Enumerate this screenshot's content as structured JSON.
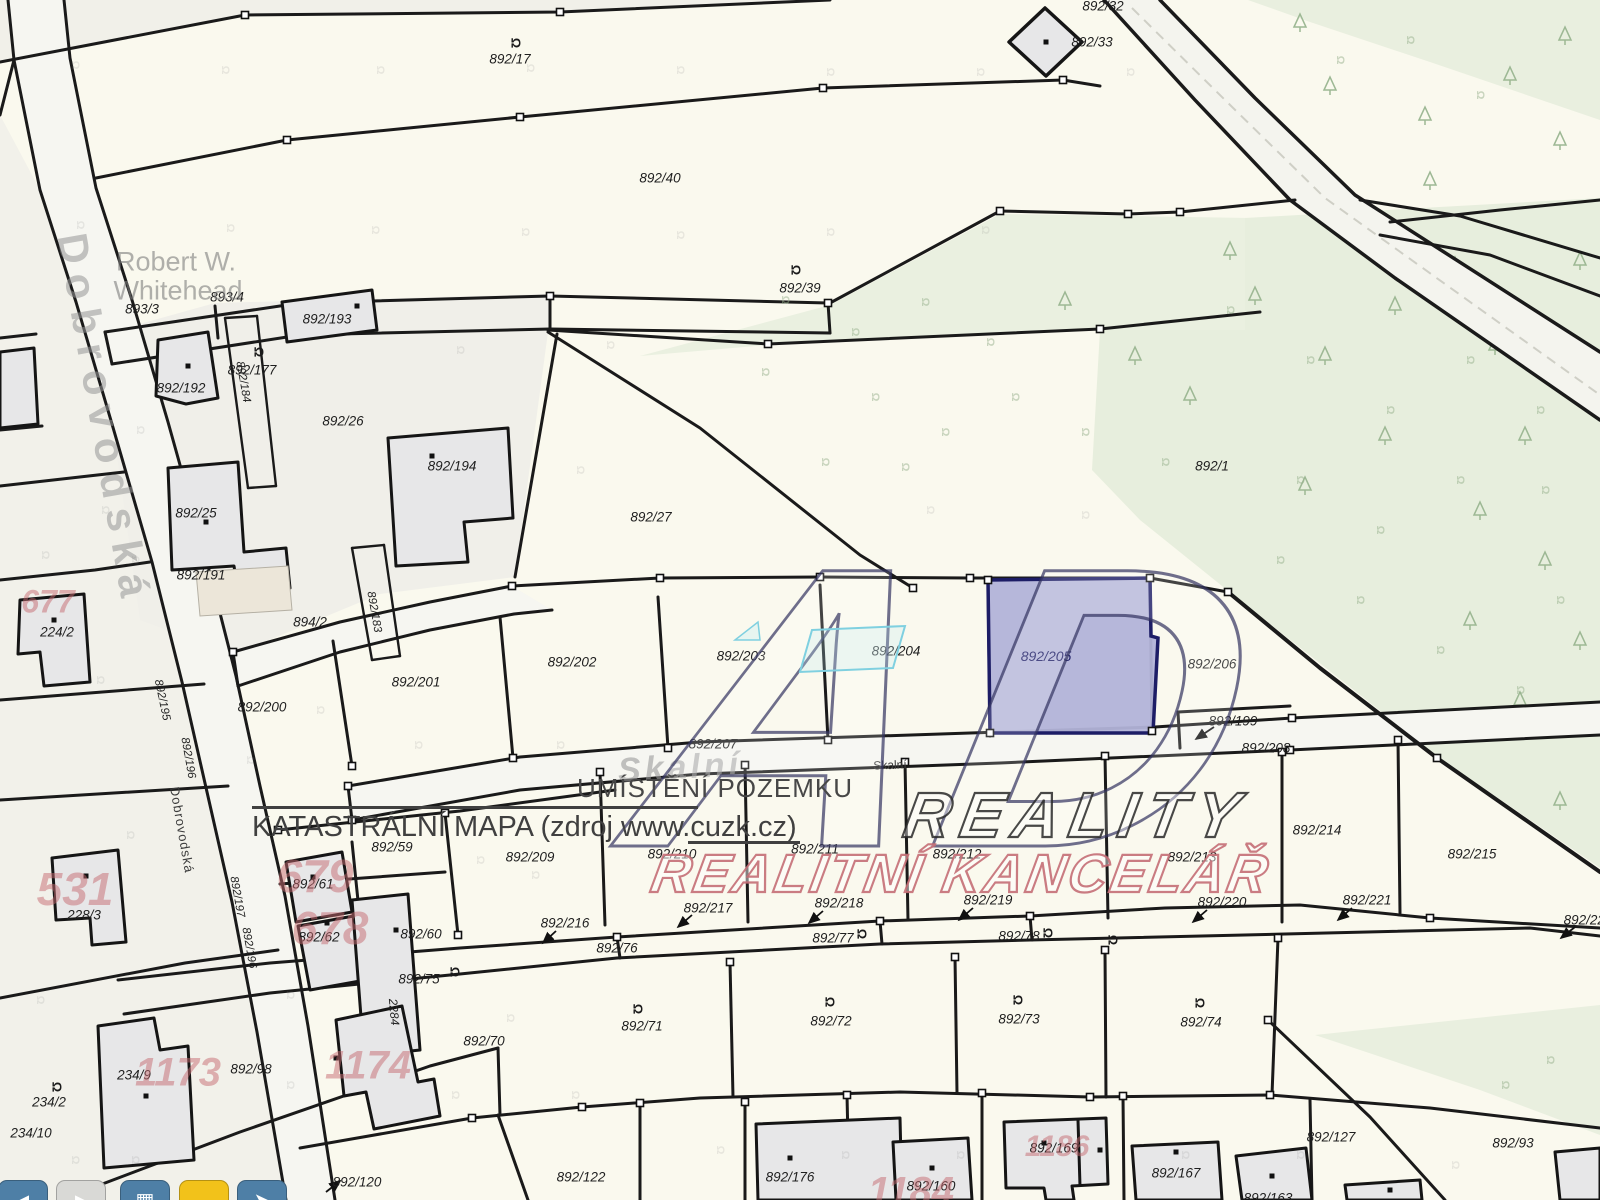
{
  "map": {
    "notes": {
      "placement": "UMÍSTĚNÍ POZEMKU",
      "source": "KATASTRÁLNÍ MAPA (zdroj www.cuzk.cz)"
    },
    "watermark": {
      "logo": "AD",
      "line1": "REALITY",
      "line2": "REALITNÍ KANCELÁŘ"
    },
    "highlighted_parcel": "892/205",
    "colors": {
      "highlight_fill": "#b2b3d8",
      "highlight_border": "#1d1d66",
      "map_background": "#faf9ee",
      "forest_green": "#e9efdf",
      "building_grey": "#e7e7e8",
      "red_number": "#c66970",
      "toolbar_blue": "#4e7fa6",
      "toolbar_yellow": "#f2c21a",
      "toolbar_grey": "#d9d9d6"
    },
    "labels": [
      [
        "892/17",
        510,
        59,
        "p"
      ],
      [
        "892/32",
        1103,
        6,
        "p"
      ],
      [
        "892/33",
        1092,
        42,
        "p"
      ],
      [
        "892/40",
        660,
        178,
        "p"
      ],
      [
        "892/39",
        800,
        288,
        "p"
      ],
      [
        "892/1",
        1212,
        466,
        "p"
      ],
      [
        "893/3",
        142,
        309,
        "p"
      ],
      [
        "893/4",
        227,
        297,
        "p"
      ],
      [
        "892/193",
        327,
        319,
        "p"
      ],
      [
        "892/177",
        252,
        370,
        "p"
      ],
      [
        "892/192",
        181,
        388,
        "p"
      ],
      [
        "892/26",
        343,
        421,
        "p"
      ],
      [
        "892/194",
        452,
        466,
        "p"
      ],
      [
        "892/25",
        196,
        513,
        "p"
      ],
      [
        "892/191",
        201,
        575,
        "p"
      ],
      [
        "892/27",
        651,
        517,
        "p"
      ],
      [
        "894/2",
        310,
        622,
        "p"
      ],
      [
        "224/2",
        57,
        632,
        "p"
      ],
      [
        "892/200",
        262,
        707,
        "p"
      ],
      [
        "892/201",
        416,
        682,
        "p"
      ],
      [
        "892/202",
        572,
        662,
        "p"
      ],
      [
        "892/203",
        741,
        656,
        "p"
      ],
      [
        "892/204",
        896,
        651,
        "p"
      ],
      [
        "892/205",
        1046,
        656,
        "pn",
        14
      ],
      [
        "892/206",
        1212,
        664,
        "p"
      ],
      [
        "892/199",
        1233,
        721,
        "p"
      ],
      [
        "892/207",
        713,
        744,
        "p"
      ],
      [
        "892/208",
        1266,
        748,
        "p"
      ],
      [
        "892/214",
        1317,
        830,
        "p"
      ],
      [
        "892/215",
        1472,
        854,
        "p"
      ],
      [
        "892/213",
        1192,
        857,
        "p"
      ],
      [
        "892/212",
        957,
        854,
        "p"
      ],
      [
        "892/211",
        815,
        849,
        "p"
      ],
      [
        "892/210",
        672,
        854,
        "p"
      ],
      [
        "892/209",
        530,
        857,
        "p"
      ],
      [
        "892/59",
        392,
        847,
        "p"
      ],
      [
        "892/61",
        313,
        884,
        "p"
      ],
      [
        "892/62",
        319,
        937,
        "p"
      ],
      [
        "892/60",
        421,
        934,
        "p"
      ],
      [
        "892/216",
        565,
        923,
        "p"
      ],
      [
        "892/217",
        708,
        908,
        "p"
      ],
      [
        "892/218",
        839,
        903,
        "p"
      ],
      [
        "892/219",
        988,
        900,
        "p"
      ],
      [
        "892/220",
        1222,
        902,
        "p"
      ],
      [
        "892/221",
        1367,
        900,
        "p"
      ],
      [
        "892/222",
        1588,
        920,
        "p"
      ],
      [
        "892/75",
        419,
        979,
        "p"
      ],
      [
        "892/76",
        617,
        948,
        "p"
      ],
      [
        "892/77",
        833,
        938,
        "p"
      ],
      [
        "892/78",
        1019,
        936,
        "p"
      ],
      [
        "892/71",
        642,
        1026,
        "p"
      ],
      [
        "892/72",
        831,
        1021,
        "p"
      ],
      [
        "892/73",
        1019,
        1019,
        "p"
      ],
      [
        "892/74",
        1201,
        1022,
        "p"
      ],
      [
        "228/3",
        84,
        915,
        "p"
      ],
      [
        "234/9",
        134,
        1075,
        "p"
      ],
      [
        "234/2",
        49,
        1102,
        "p"
      ],
      [
        "234/10",
        31,
        1133,
        "p"
      ],
      [
        "892/98",
        251,
        1069,
        "p"
      ],
      [
        "892/70",
        484,
        1041,
        "p"
      ],
      [
        "892/120",
        357,
        1182,
        "p"
      ],
      [
        "892/122",
        581,
        1177,
        "p"
      ],
      [
        "892/176",
        790,
        1177,
        "p"
      ],
      [
        "892/160",
        931,
        1186,
        "p"
      ],
      [
        "892/169",
        1054,
        1148,
        "p"
      ],
      [
        "892/167",
        1176,
        1173,
        "p"
      ],
      [
        "892/127",
        1331,
        1137,
        "p"
      ],
      [
        "892/93",
        1513,
        1143,
        "p"
      ],
      [
        "892/163",
        1268,
        1198,
        "p"
      ],
      [
        "892/184",
        243,
        382,
        "v",
        11.5,
        80
      ],
      [
        "892/183",
        374,
        612,
        "v",
        11.5,
        80
      ],
      [
        "892/195",
        162,
        700,
        "v",
        11.5,
        78
      ],
      [
        "892/196",
        188,
        758,
        "v",
        11.5,
        80
      ],
      [
        "892/197",
        237,
        897,
        "v",
        11.5,
        80
      ],
      [
        "892/196",
        249,
        948,
        "v",
        11.5,
        80
      ],
      [
        "2284",
        394,
        1012,
        "v",
        12,
        85
      ],
      [
        "677",
        48,
        602,
        "red",
        32
      ],
      [
        "531",
        75,
        889,
        "red",
        46
      ],
      [
        "679",
        315,
        876,
        "red",
        46
      ],
      [
        "678",
        330,
        928,
        "red",
        46
      ],
      [
        "1173",
        178,
        1073,
        "red",
        40
      ],
      [
        "1174",
        368,
        1066,
        "red",
        40
      ],
      [
        "1184",
        911,
        1192,
        "red",
        40
      ],
      [
        "1186",
        1057,
        1147,
        "red",
        30
      ],
      [
        "Dobrovodská",
        104,
        420,
        "sb",
        42,
        80,
        10
      ],
      [
        "Dobrovodská",
        182,
        830,
        "ss",
        13,
        80,
        1
      ],
      [
        "Skalní",
        680,
        768,
        "sb2",
        34,
        -3,
        4
      ],
      [
        "Skalní",
        890,
        765,
        "ss",
        12,
        -2,
        0
      ],
      [
        "Robert W.",
        176,
        262,
        "ow",
        27
      ],
      [
        "Whitehead",
        178,
        291,
        "ow",
        27
      ]
    ],
    "landuse_symbols": [
      [
        516,
        43
      ],
      [
        259,
        352
      ],
      [
        796,
        270
      ],
      [
        862,
        934
      ],
      [
        1048,
        933
      ],
      [
        638,
        1009
      ],
      [
        830,
        1002
      ],
      [
        1018,
        1000
      ],
      [
        1200,
        1003
      ],
      [
        57,
        1087
      ],
      [
        455,
        972
      ],
      [
        1113,
        940
      ]
    ],
    "green_symbols": [
      [
        785,
        300
      ],
      [
        855,
        332
      ],
      [
        925,
        302
      ],
      [
        990,
        342
      ],
      [
        875,
        397
      ],
      [
        945,
        432
      ],
      [
        1015,
        397
      ],
      [
        765,
        372
      ],
      [
        1085,
        432
      ],
      [
        1165,
        462
      ],
      [
        825,
        462
      ],
      [
        905,
        467
      ],
      [
        1230,
        310
      ],
      [
        1310,
        360
      ],
      [
        1390,
        410
      ],
      [
        1470,
        360
      ],
      [
        1540,
        410
      ],
      [
        1300,
        480
      ],
      [
        1380,
        530
      ],
      [
        1460,
        480
      ],
      [
        1545,
        490
      ],
      [
        1280,
        560
      ],
      [
        1360,
        600
      ],
      [
        1440,
        650
      ],
      [
        1520,
        690
      ],
      [
        1560,
        600
      ],
      [
        1340,
        60
      ],
      [
        1410,
        40
      ],
      [
        1480,
        95
      ],
      [
        1550,
        1060
      ],
      [
        1505,
        1085
      ]
    ],
    "faint_symbols": [
      [
        75,
        65
      ],
      [
        225,
        70
      ],
      [
        380,
        70
      ],
      [
        530,
        68
      ],
      [
        680,
        70
      ],
      [
        830,
        72
      ],
      [
        980,
        72
      ],
      [
        1130,
        72
      ],
      [
        80,
        225
      ],
      [
        230,
        228
      ],
      [
        375,
        230
      ],
      [
        525,
        232
      ],
      [
        680,
        235
      ],
      [
        830,
        232
      ],
      [
        985,
        230
      ],
      [
        45,
        555
      ],
      [
        135,
        560
      ],
      [
        100,
        680
      ],
      [
        130,
        835
      ],
      [
        40,
        1000
      ],
      [
        75,
        1160
      ],
      [
        135,
        1160
      ],
      [
        290,
        1085
      ],
      [
        455,
        1095
      ],
      [
        575,
        1095
      ],
      [
        510,
        1018
      ],
      [
        720,
        1150
      ],
      [
        845,
        1155
      ],
      [
        960,
        1155
      ],
      [
        1185,
        1155
      ],
      [
        1300,
        1155
      ],
      [
        1455,
        1165
      ],
      [
        418,
        745
      ],
      [
        560,
        745
      ],
      [
        930,
        510
      ],
      [
        1085,
        515
      ],
      [
        610,
        345
      ],
      [
        580,
        470
      ],
      [
        460,
        350
      ],
      [
        105,
        510
      ],
      [
        140,
        430
      ],
      [
        290,
        995
      ],
      [
        250,
        760
      ],
      [
        320,
        710
      ],
      [
        480,
        860
      ],
      [
        535,
        875
      ]
    ],
    "trees": [
      [
        1330,
        85
      ],
      [
        1425,
        115
      ],
      [
        1510,
        75
      ],
      [
        1565,
        35
      ],
      [
        1300,
        22
      ],
      [
        1065,
        300
      ],
      [
        1135,
        355
      ],
      [
        1190,
        395
      ],
      [
        1255,
        295
      ],
      [
        1325,
        355
      ],
      [
        1395,
        305
      ],
      [
        1455,
        265
      ],
      [
        1385,
        435
      ],
      [
        1305,
        485
      ],
      [
        1495,
        345
      ],
      [
        1525,
        435
      ],
      [
        1430,
        180
      ],
      [
        1560,
        140
      ],
      [
        1580,
        260
      ],
      [
        1230,
        250
      ],
      [
        1480,
        510
      ],
      [
        1545,
        560
      ],
      [
        1580,
        640
      ],
      [
        1520,
        700
      ],
      [
        1560,
        800
      ],
      [
        1470,
        620
      ]
    ],
    "vertex_nodes": [
      [
        245,
        15
      ],
      [
        560,
        12
      ],
      [
        823,
        88
      ],
      [
        1063,
        80
      ],
      [
        287,
        140
      ],
      [
        520,
        117
      ],
      [
        550,
        296
      ],
      [
        828,
        303
      ],
      [
        1000,
        211
      ],
      [
        1128,
        214
      ],
      [
        1180,
        212
      ],
      [
        768,
        344
      ],
      [
        1100,
        329
      ],
      [
        913,
        588
      ],
      [
        660,
        578
      ],
      [
        820,
        577
      ],
      [
        970,
        578
      ],
      [
        1150,
        578
      ],
      [
        1228,
        592
      ],
      [
        988,
        580
      ],
      [
        990,
        733
      ],
      [
        1152,
        731
      ],
      [
        352,
        766
      ],
      [
        513,
        758
      ],
      [
        668,
        748
      ],
      [
        828,
        740
      ],
      [
        600,
        772
      ],
      [
        745,
        765
      ],
      [
        905,
        762
      ],
      [
        1105,
        756
      ],
      [
        1282,
        752
      ],
      [
        1292,
        718
      ],
      [
        1290,
        750
      ],
      [
        617,
        937
      ],
      [
        880,
        921
      ],
      [
        1030,
        916
      ],
      [
        1430,
        918
      ],
      [
        730,
        962
      ],
      [
        955,
        957
      ],
      [
        1105,
        950
      ],
      [
        1278,
        938
      ],
      [
        472,
        1118
      ],
      [
        582,
        1107
      ],
      [
        640,
        1103
      ],
      [
        745,
        1102
      ],
      [
        982,
        1093
      ],
      [
        1090,
        1097
      ],
      [
        1123,
        1096
      ],
      [
        1270,
        1095
      ],
      [
        445,
        813
      ],
      [
        458,
        935
      ],
      [
        278,
        830
      ],
      [
        233,
        652
      ],
      [
        512,
        586
      ],
      [
        1437,
        758
      ],
      [
        348,
        786
      ],
      [
        352,
        820
      ],
      [
        1398,
        740
      ],
      [
        847,
        1095
      ],
      [
        1268,
        1020
      ]
    ],
    "building_dots": [
      [
        357,
        306
      ],
      [
        188,
        366
      ],
      [
        432,
        456
      ],
      [
        206,
        522
      ],
      [
        54,
        620
      ],
      [
        86,
        876
      ],
      [
        313,
        877
      ],
      [
        327,
        923
      ],
      [
        396,
        930
      ],
      [
        336,
        1058
      ],
      [
        146,
        1096
      ],
      [
        1046,
        42
      ],
      [
        790,
        1158
      ],
      [
        932,
        1168
      ],
      [
        1044,
        1143
      ],
      [
        1100,
        1150
      ],
      [
        1176,
        1152
      ],
      [
        1272,
        1176
      ],
      [
        1390,
        1190
      ]
    ],
    "toolbar": {
      "buttons": [
        {
          "name": "back-button",
          "color": "#4e7fa6",
          "glyph": "◄",
          "glyph_color": "#ffffff"
        },
        {
          "name": "forward-button",
          "color": "#d9d9d6",
          "glyph": "►",
          "glyph_color": "#ffffff"
        },
        {
          "name": "layers-button",
          "color": "#4e7fa6",
          "glyph": "▦",
          "glyph_color": "#ffffff"
        },
        {
          "name": "highlight-button",
          "color": "#f2c21a",
          "glyph": "",
          "glyph_color": "#ffffff"
        },
        {
          "name": "pan-button",
          "color": "#4e7fa6",
          "glyph": "➤",
          "glyph_color": "#ffffff"
        }
      ]
    }
  }
}
